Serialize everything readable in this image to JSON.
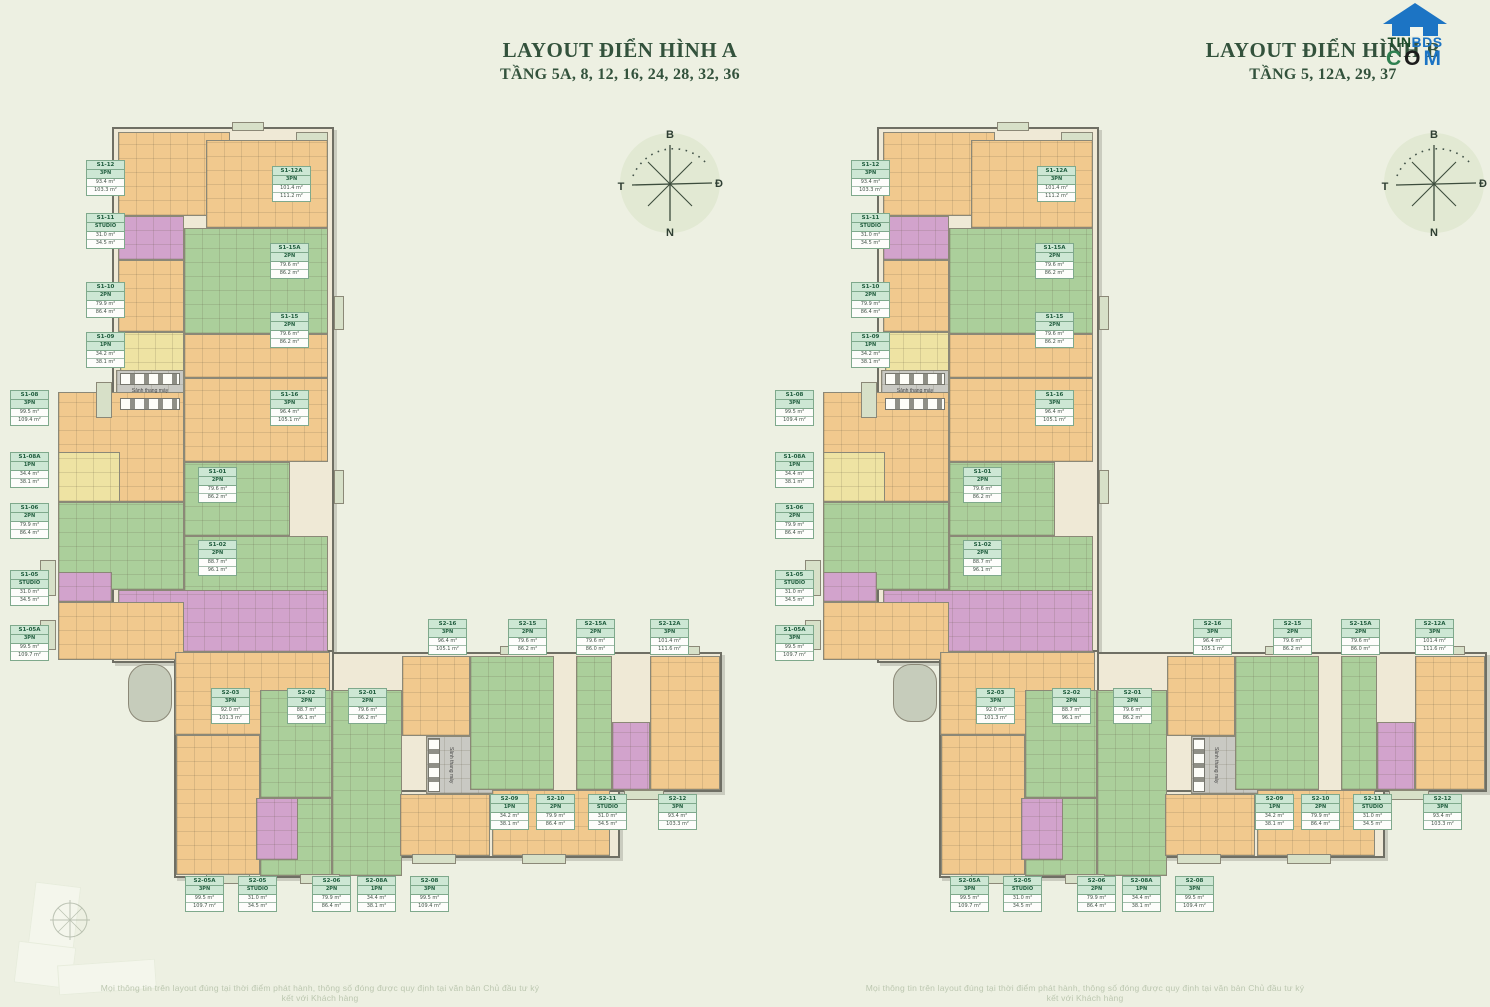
{
  "header": {
    "layout_a": {
      "title": "LAYOUT ĐIỂN HÌNH A",
      "subtitle": "TẦNG 5A, 8, 12, 16, 24, 28, 32, 36"
    },
    "layout_b": {
      "title": "LAYOUT ĐIỂN HÌNH B",
      "subtitle": "TẦNG 5, 12A, 29, 37"
    }
  },
  "logo": {
    "tin": "TIN",
    "bds": "BDS",
    "c": "C",
    "o": "O",
    "m": "M"
  },
  "compass": {
    "north": "B",
    "east": "Đ",
    "south": "N",
    "west": "T"
  },
  "core": {
    "lobby": "Sảnh thang máy"
  },
  "footer": {
    "disclaimer": "Mọi thông tin trên layout đúng tại thời điểm phát hành, thông số đóng được quy định tại văn bản Chủ đầu tư ký kết với Khách hàng"
  },
  "colors": {
    "background": "#edf0e2",
    "title_green": "#33523c",
    "unit_orange": "#f1c98e",
    "unit_green": "#abcf9b",
    "unit_purple": "#d2a3cc",
    "unit_yellow": "#eee3a3",
    "core_gray": "#c9c9c3",
    "label_green": "#cde7d4",
    "logo_blue": "#1c74c4"
  },
  "units": [
    {
      "code": "S1-12",
      "type": "3PN",
      "a1": "93.4 m²",
      "a2": "103.3 m²",
      "x": 86,
      "y": 160
    },
    {
      "code": "S1-11",
      "type": "STUDIO",
      "a1": "31.0 m²",
      "a2": "34.5 m²",
      "x": 86,
      "y": 213
    },
    {
      "code": "S1-10",
      "type": "2PN",
      "a1": "79.9 m²",
      "a2": "86.4 m²",
      "x": 86,
      "y": 282
    },
    {
      "code": "S1-09",
      "type": "1PN",
      "a1": "34.2 m²",
      "a2": "38.1 m²",
      "x": 86,
      "y": 332
    },
    {
      "code": "S1-08",
      "type": "3PN",
      "a1": "99.5 m²",
      "a2": "109.4 m²",
      "x": 10,
      "y": 390
    },
    {
      "code": "S1-08A",
      "type": "1PN",
      "a1": "34.4 m²",
      "a2": "38.1 m²",
      "x": 10,
      "y": 452
    },
    {
      "code": "S1-06",
      "type": "2PN",
      "a1": "79.9 m²",
      "a2": "86.4 m²",
      "x": 10,
      "y": 503
    },
    {
      "code": "S1-05",
      "type": "STUDIO",
      "a1": "31.0 m²",
      "a2": "34.5 m²",
      "x": 10,
      "y": 570
    },
    {
      "code": "S1-05A",
      "type": "3PN",
      "a1": "99.5 m²",
      "a2": "109.7 m²",
      "x": 10,
      "y": 625
    },
    {
      "code": "S1-12A",
      "type": "3PN",
      "a1": "101.4 m²",
      "a2": "111.2 m²",
      "x": 272,
      "y": 166
    },
    {
      "code": "S1-15A",
      "type": "2PN",
      "a1": "79.6 m²",
      "a2": "86.2 m²",
      "x": 270,
      "y": 243
    },
    {
      "code": "S1-15",
      "type": "2PN",
      "a1": "79.6 m²",
      "a2": "86.2 m²",
      "x": 270,
      "y": 312
    },
    {
      "code": "S1-16",
      "type": "3PN",
      "a1": "96.4 m²",
      "a2": "105.1 m²",
      "x": 270,
      "y": 390
    },
    {
      "code": "S1-01",
      "type": "2PN",
      "a1": "79.6 m²",
      "a2": "86.2 m²",
      "x": 198,
      "y": 467
    },
    {
      "code": "S1-02",
      "type": "2PN",
      "a1": "88.7 m²",
      "a2": "96.1 m²",
      "x": 198,
      "y": 540
    },
    {
      "code": "S2-03",
      "type": "3PN",
      "a1": "92.0 m²",
      "a2": "101.3 m²",
      "x": 211,
      "y": 688
    },
    {
      "code": "S2-02",
      "type": "2PN",
      "a1": "88.7 m²",
      "a2": "96.1 m²",
      "x": 287,
      "y": 688
    },
    {
      "code": "S2-01",
      "type": "2PN",
      "a1": "79.6 m²",
      "a2": "86.2 m²",
      "x": 348,
      "y": 688
    },
    {
      "code": "S2-16",
      "type": "3PN",
      "a1": "96.4 m²",
      "a2": "105.1 m²",
      "x": 428,
      "y": 619
    },
    {
      "code": "S2-15",
      "type": "2PN",
      "a1": "79.6 m²",
      "a2": "86.2 m²",
      "x": 508,
      "y": 619
    },
    {
      "code": "S2-15A",
      "type": "2PN",
      "a1": "79.6 m²",
      "a2": "86.0 m²",
      "x": 576,
      "y": 619
    },
    {
      "code": "S2-12A",
      "type": "3PN",
      "a1": "101.4 m²",
      "a2": "111.6 m²",
      "x": 650,
      "y": 619
    },
    {
      "code": "S2-09",
      "type": "1PN",
      "a1": "34.2 m²",
      "a2": "38.1 m²",
      "x": 490,
      "y": 794
    },
    {
      "code": "S2-10",
      "type": "2PN",
      "a1": "79.9 m²",
      "a2": "86.4 m²",
      "x": 536,
      "y": 794
    },
    {
      "code": "S2-11",
      "type": "STUDIO",
      "a1": "31.0 m²",
      "a2": "34.5 m²",
      "x": 588,
      "y": 794
    },
    {
      "code": "S2-12",
      "type": "3PN",
      "a1": "93.4 m²",
      "a2": "103.3 m²",
      "x": 658,
      "y": 794
    },
    {
      "code": "S2-05A",
      "type": "3PN",
      "a1": "99.5 m²",
      "a2": "109.7 m²",
      "x": 185,
      "y": 876
    },
    {
      "code": "S2-05",
      "type": "STUDIO",
      "a1": "31.0 m²",
      "a2": "34.5 m²",
      "x": 238,
      "y": 876
    },
    {
      "code": "S2-06",
      "type": "2PN",
      "a1": "79.9 m²",
      "a2": "86.4 m²",
      "x": 312,
      "y": 876
    },
    {
      "code": "S2-08A",
      "type": "1PN",
      "a1": "34.4 m²",
      "a2": "38.1 m²",
      "x": 357,
      "y": 876
    },
    {
      "code": "S2-08",
      "type": "3PN",
      "a1": "99.5 m²",
      "a2": "109.4 m²",
      "x": 410,
      "y": 876
    }
  ]
}
